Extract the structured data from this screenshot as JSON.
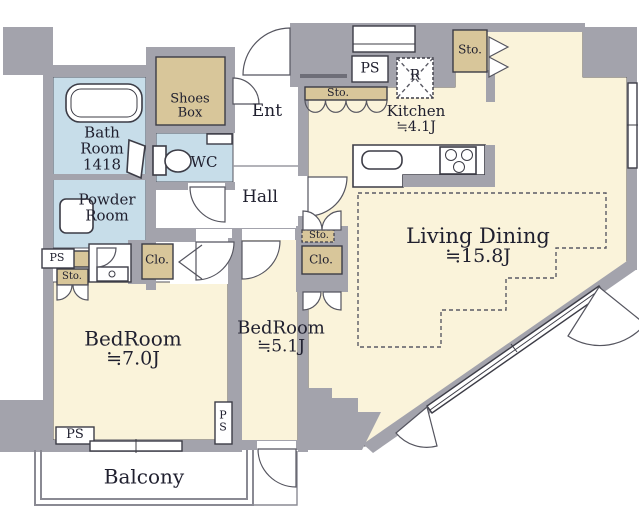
{
  "colors": {
    "wall": "#a3a3ac",
    "wet_room": "#c7dde9",
    "storage_tan": "#d8c69a",
    "floor_cream": "#faf3da",
    "text": "#20202f",
    "balcony_line": "#8a8a93"
  },
  "rooms": {
    "bath": {
      "lines": [
        "Bath",
        "Room",
        "1418"
      ]
    },
    "powder": {
      "lines": [
        "Powder",
        "Room"
      ]
    },
    "wc": {
      "label": "WC"
    },
    "shoes_box": {
      "lines": [
        "Shoes",
        "Box"
      ]
    },
    "entrance": {
      "label": "Ent"
    },
    "hall": {
      "label": "Hall"
    },
    "kitchen": {
      "label": "Kitchen",
      "area": "≒4.1J"
    },
    "living_dining": {
      "label": "Living Dining",
      "area": "≒15.8J"
    },
    "bedroom_7": {
      "label": "BedRoom",
      "area": "≒7.0J"
    },
    "bedroom_5": {
      "label": "BedRoom",
      "area": "≒5.1J"
    },
    "balcony": {
      "label": "Balcony"
    }
  },
  "annotations": {
    "ps": "PS",
    "refrigerator": "R",
    "storage": "Sto.",
    "closet": "Clo.",
    "ps_vertical": [
      "P",
      "S"
    ]
  }
}
